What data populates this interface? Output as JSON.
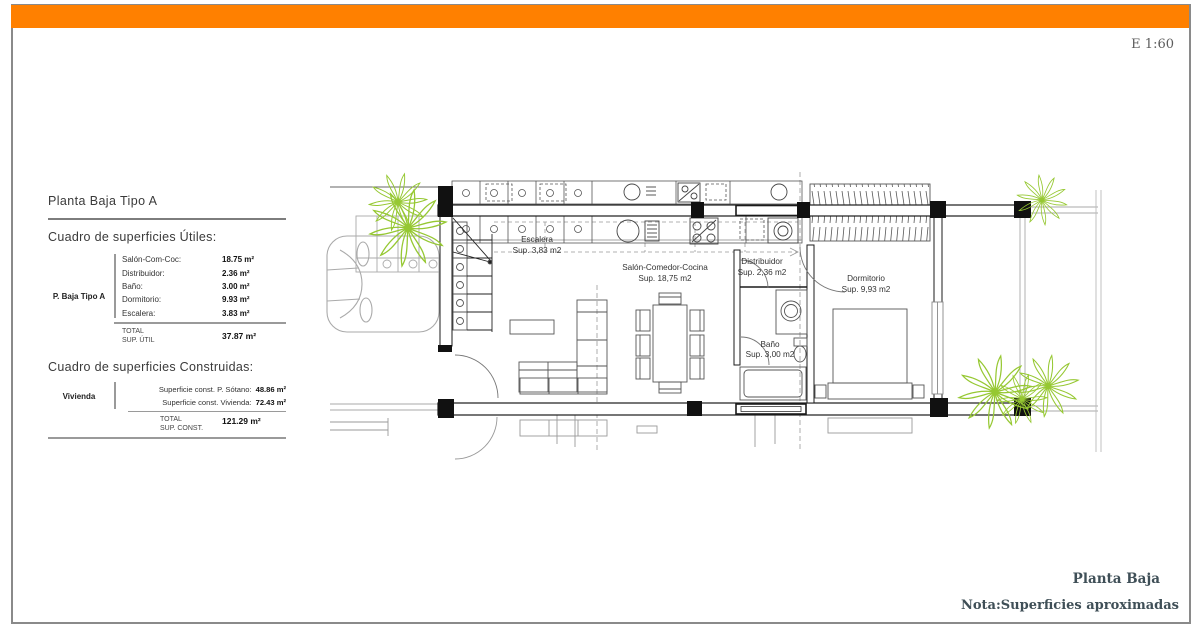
{
  "sheet": {
    "scale_label": "E 1:60",
    "footer_title": "Planta Baja",
    "footer_note": "Nota:Superficies aproximadas",
    "accent_color": "#FF8000",
    "border_color": "#8a8a8a"
  },
  "panel": {
    "title": "Planta Baja Tipo A",
    "utiles": {
      "heading": "Cuadro de superficies Útiles:",
      "group_label": "P. Baja Tipo A",
      "rows": [
        {
          "label": "Salón-Com-Coc:",
          "value": "18.75 m²"
        },
        {
          "label": "Distribuidor:",
          "value": "2.36 m²"
        },
        {
          "label": "Baño:",
          "value": "3.00 m²"
        },
        {
          "label": "Dormitorio:",
          "value": "9.93 m²"
        },
        {
          "label": "Escalera:",
          "value": "3.83 m²"
        }
      ],
      "total_label": "TOTAL",
      "total_sublabel": "SUP. ÚTIL",
      "total_value": "37.87 m²"
    },
    "construidas": {
      "heading": "Cuadro de superficies Construidas:",
      "group_label": "Vivienda",
      "rows": [
        {
          "label": "Superficie const. P. Sótano:",
          "value": "48.86 m²"
        },
        {
          "label": "Superficie const. Vivienda:",
          "value": "72.43 m²"
        }
      ],
      "total_label": "TOTAL",
      "total_sublabel": "SUP. CONST.",
      "total_value": "121.29 m²"
    }
  },
  "plan": {
    "rooms": [
      {
        "name": "Escalera",
        "area": "Sup. 3,83 m2"
      },
      {
        "name": "Salón-Comedor-Cocina",
        "area": "Sup. 18,75 m2"
      },
      {
        "name": "Distribuidor",
        "area": "Sup. 2,36 m2"
      },
      {
        "name": "Dormitorio",
        "area": "Sup. 9,93 m2"
      },
      {
        "name": "Baño",
        "area": "Sup. 3,00 m2"
      }
    ],
    "colors": {
      "plant_green": "#96C832",
      "wall": "#1b1b1b",
      "light_gray": "#aaaaaa"
    }
  }
}
